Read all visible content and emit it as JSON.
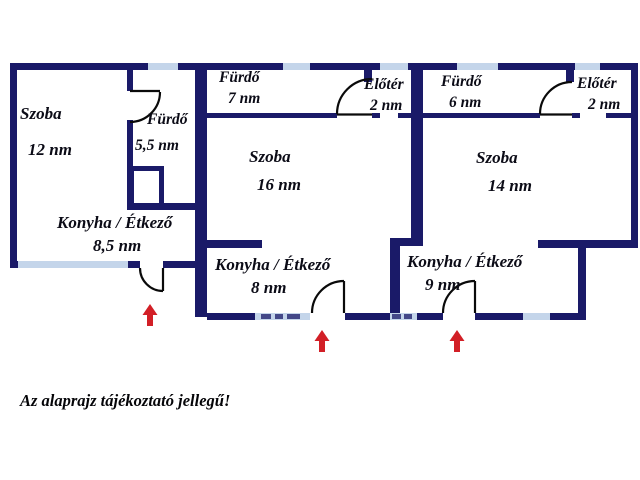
{
  "colors": {
    "wall": "#1a1a68",
    "window": "#c4d5ea",
    "door_line": "#0a0a0a",
    "arrow": "#d21f26",
    "label_text": "#0b0b16"
  },
  "rooms": [
    {
      "name": "Szoba",
      "area": "12 nm"
    },
    {
      "name": "Fürdő",
      "area": "5,5 nm"
    },
    {
      "name": "Konyha / Étkező",
      "area": "8,5 nm"
    },
    {
      "name": "Fürdő",
      "area": "7 nm"
    },
    {
      "name": "Előtér",
      "area": "2 nm"
    },
    {
      "name": "Szoba",
      "area": "16 nm"
    },
    {
      "name": "Konyha / Étkező",
      "area": "8 nm"
    },
    {
      "name": "Fürdő",
      "area": "6 nm"
    },
    {
      "name": "Előtér",
      "area": "2 nm"
    },
    {
      "name": "Szoba",
      "area": "14 nm"
    },
    {
      "name": "Konyha / Étkező",
      "area": "9 nm"
    }
  ],
  "disclaimer": "Az alaprajz tájékoztató jellegű!"
}
